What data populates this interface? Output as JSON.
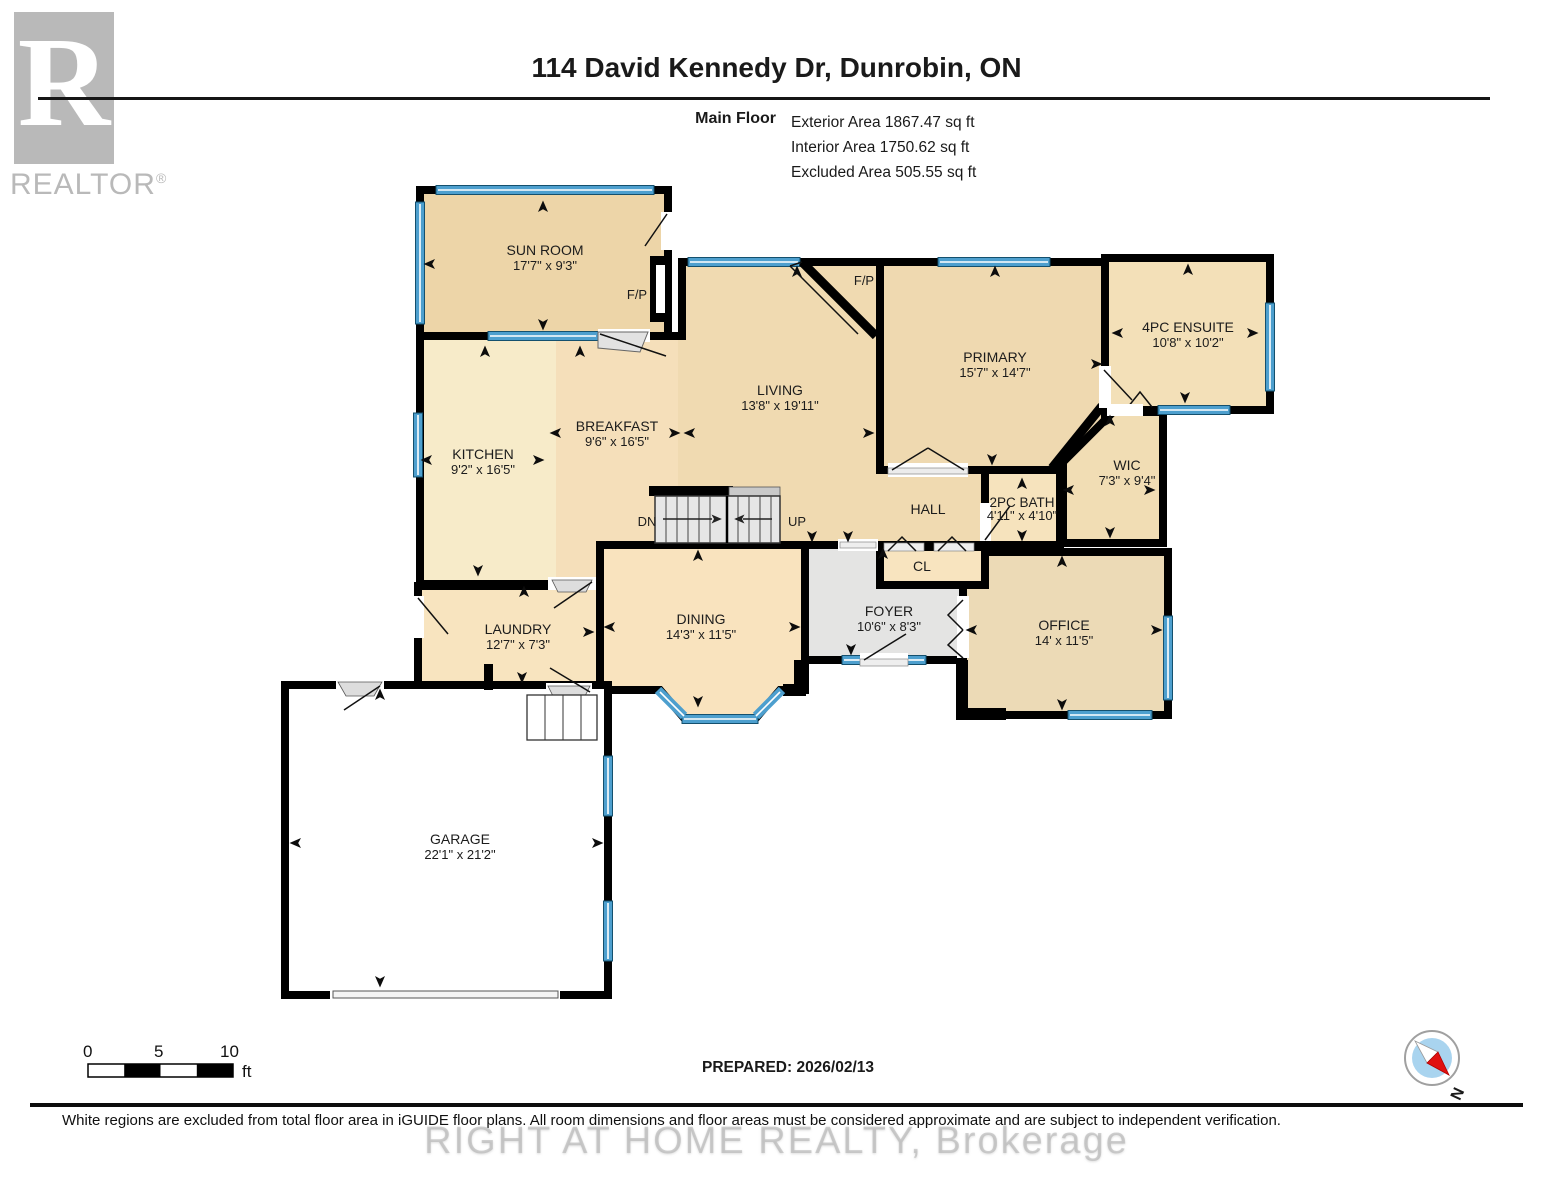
{
  "header": {
    "logo_letter": "R",
    "logo_word": "REALTOR",
    "logo_reg": "®",
    "title": "114 David Kennedy Dr, Dunrobin, ON",
    "floor_label": "Main Floor",
    "stats": {
      "exterior": "Exterior Area 1867.47 sq ft",
      "interior": "Interior Area 1750.62 sq ft",
      "excluded": "Excluded Area 505.55 sq ft"
    }
  },
  "plan": {
    "rooms": [
      {
        "name": "SUN ROOM",
        "dims": "17'7\" x 9'3\""
      },
      {
        "name": "KITCHEN",
        "dims": "9'2\" x 16'5\""
      },
      {
        "name": "BREAKFAST",
        "dims": "9'6\" x 16'5\""
      },
      {
        "name": "LIVING",
        "dims": "13'8\" x 19'11\""
      },
      {
        "name": "PRIMARY",
        "dims": "15'7\" x 14'7\""
      },
      {
        "name": "4PC ENSUITE",
        "dims": "10'8\" x 10'2\""
      },
      {
        "name": "WIC",
        "dims": "7'3\" x 9'4\""
      },
      {
        "name": "2PC BATH",
        "dims": "4'11\" x 4'10\""
      },
      {
        "name": "DINING",
        "dims": "14'3\" x 11'5\""
      },
      {
        "name": "FOYER",
        "dims": "10'6\" x 8'3\""
      },
      {
        "name": "OFFICE",
        "dims": "14' x 11'5\""
      },
      {
        "name": "LAUNDRY",
        "dims": "12'7\" x 7'3\""
      },
      {
        "name": "GARAGE",
        "dims": "22'1\" x 21'2\""
      }
    ],
    "hall_label": "HALL",
    "closet_label": "CL",
    "fireplace_label": "F/P",
    "stairs_down_label": "DN",
    "stairs_up_label": "UP"
  },
  "footer": {
    "scale": {
      "tick0": "0",
      "tick5": "5",
      "tick10": "10",
      "unit": "ft"
    },
    "prepared": "PREPARED: 2026/02/13",
    "compass_north": "N",
    "disclaimer": "White regions are excluded from total floor area in iGUIDE floor plans. All room dimensions and floor areas must be considered approximate and are subject to independent verification.",
    "watermark": "RIGHT AT HOME REALTY, Brokerage"
  },
  "colors": {
    "wall": "#000000",
    "window_blue": "#4D9FCE",
    "hall_grey": "#E4E4E3",
    "excluded_white": "#FFFFFF",
    "room_tan": "#F0DAB1",
    "compass_red": "#E01010",
    "compass_blue": "#A9D4EF"
  }
}
